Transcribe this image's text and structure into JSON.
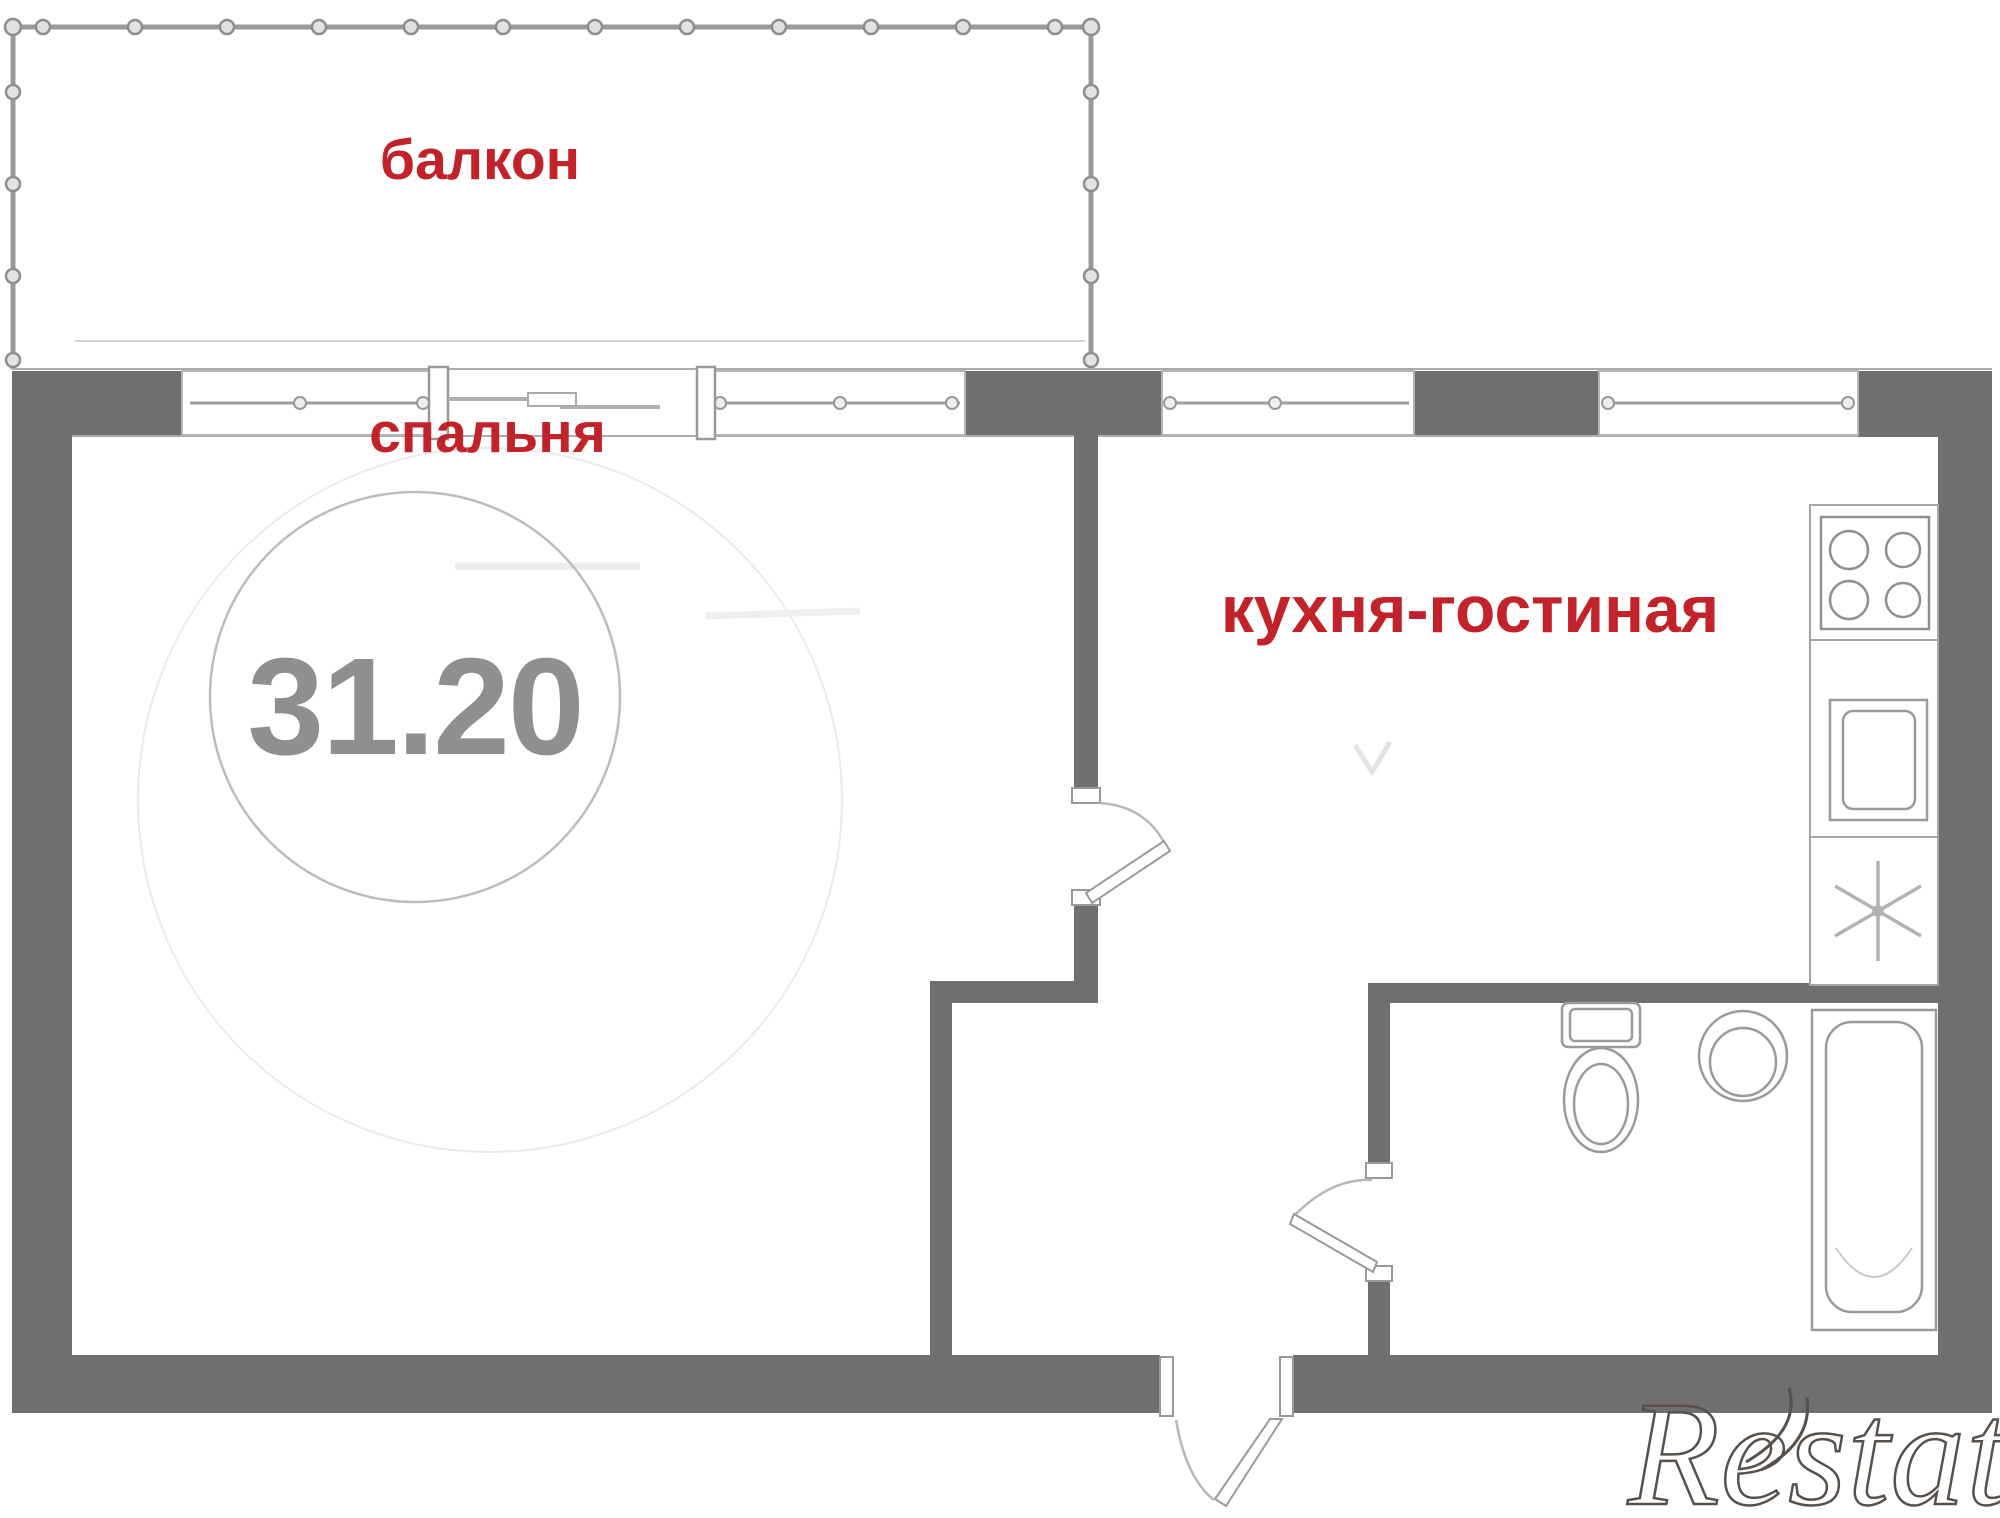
{
  "document": {
    "kind": "apartment floor plan",
    "watermark_text": "Restate"
  },
  "rooms": {
    "balcony": {
      "label": "балкон"
    },
    "bedroom": {
      "label": "спальня",
      "area": "31.20"
    },
    "kitchen_living": {
      "label": "кухня-гостиная"
    },
    "bathroom": {
      "label": ""
    }
  },
  "fixtures": {
    "stove": "stove-icon",
    "kitchen_sink": "sink-icon",
    "fridge": "snowflake-icon",
    "toilet": "toilet-icon",
    "washbasin": "washbasin-icon",
    "bathtub": "bathtub-icon"
  },
  "colors": {
    "wall": "#6f6f6f",
    "room_label_red": "#c2232a",
    "area_number_gray": "#8f8f8f",
    "fixture_line_gray": "#9a9a9a",
    "railing_gray": "#9a9a9a",
    "watermark_stroke": "#57504b",
    "background": "#ffffff"
  }
}
